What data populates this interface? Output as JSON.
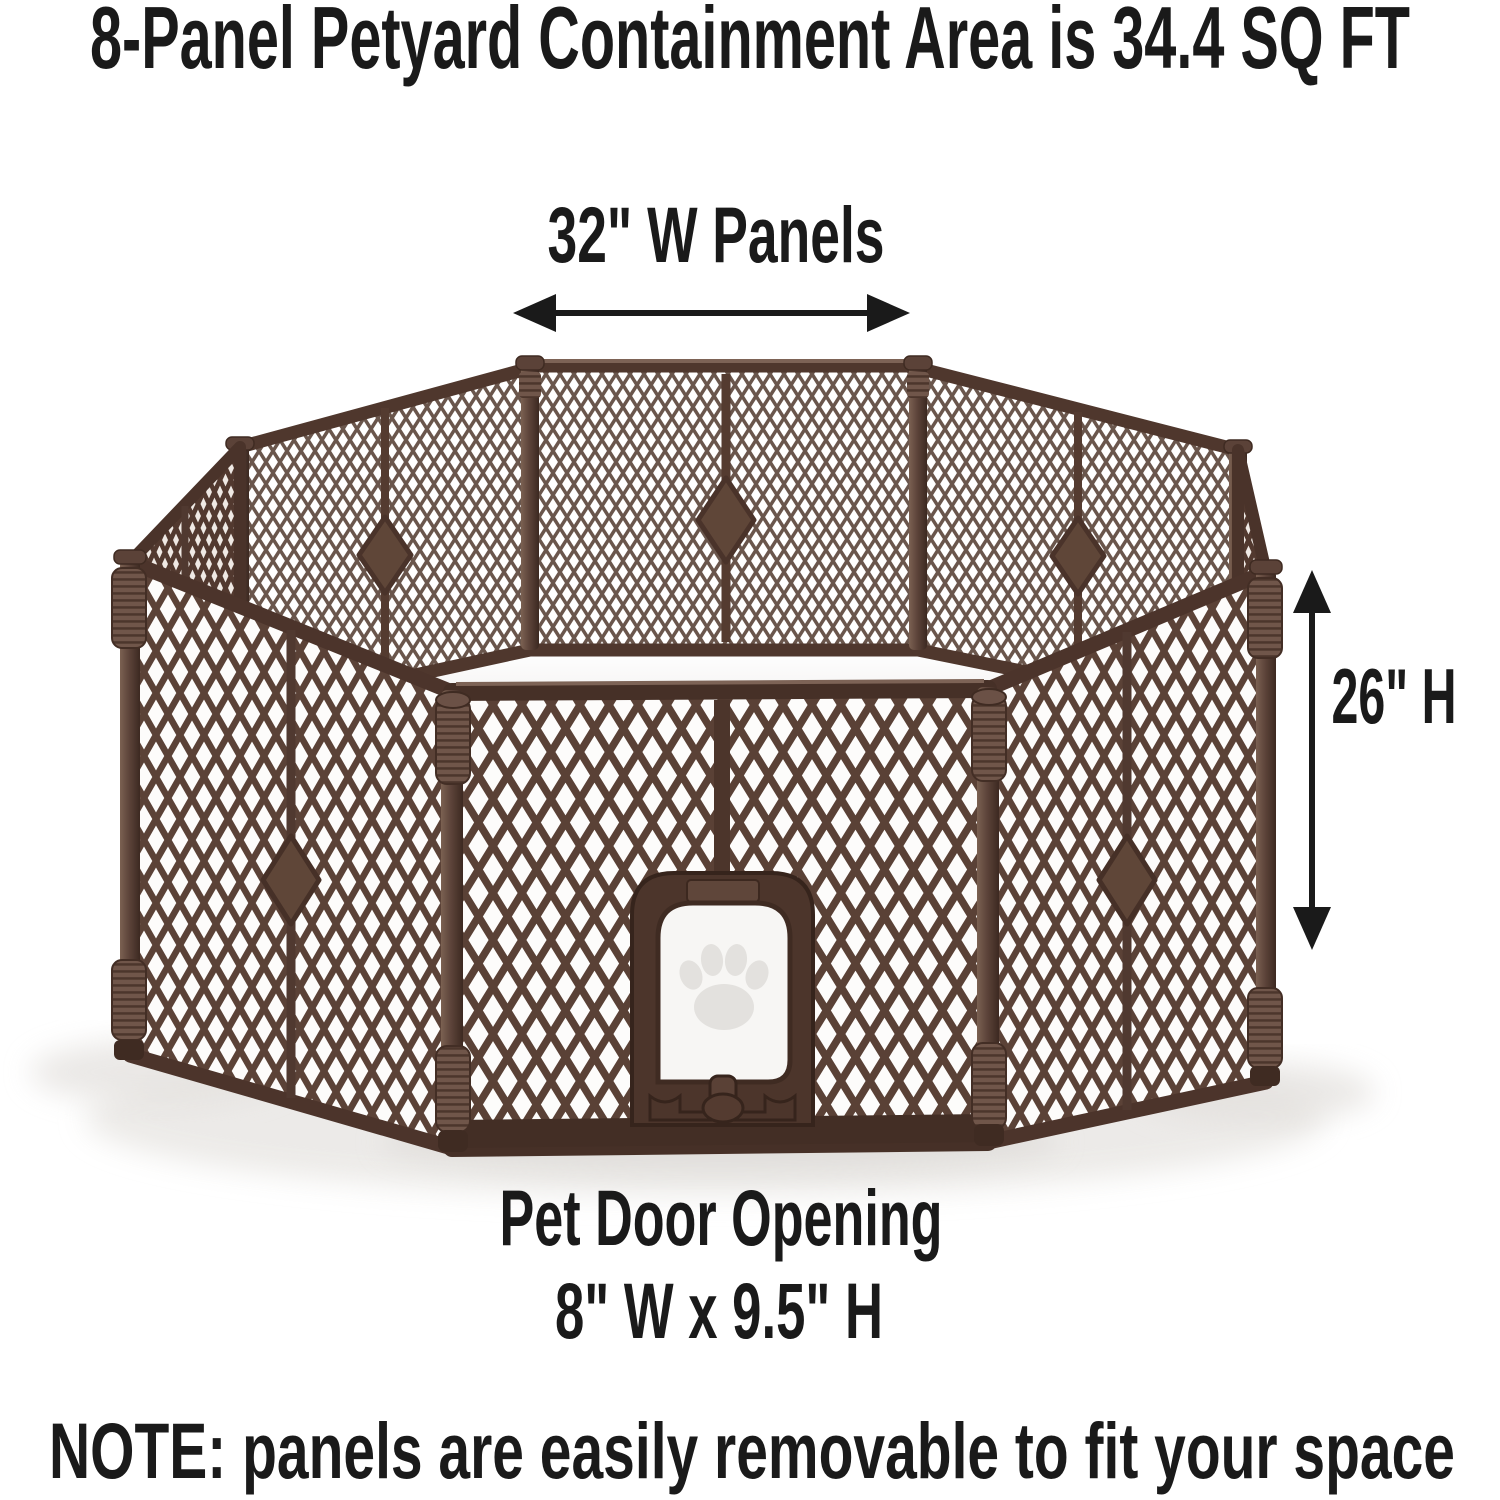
{
  "title": "8-Panel Petyard Containment Area is 34.4 SQ FT",
  "dimensions": {
    "panel_width_label": "32\" W Panels",
    "panel_height_label": "26\" H",
    "pet_door_heading": "Pet Door Opening",
    "pet_door_size_label": "8\" W x 9.5\" H"
  },
  "note": "NOTE: panels are easily removable to fit your space",
  "product": {
    "panel_count": 8,
    "containment_area_sq_ft": 34.4,
    "panel_width_in": 32,
    "panel_height_in": 26,
    "pet_door_width_in": 8,
    "pet_door_height_in": 9.5,
    "material_color_name": "brown",
    "frame_color_hex": "#4e362c",
    "mesh_color_hex": "#5e463c",
    "floor_color_hex": "#fbfafa",
    "text_color_hex": "#1a1a1a",
    "background_hex": "#ffffff"
  },
  "icons": {
    "paw_print": "paw-print-icon",
    "width_arrow": "horizontal-double-arrow-icon",
    "height_arrow": "vertical-double-arrow-icon"
  }
}
